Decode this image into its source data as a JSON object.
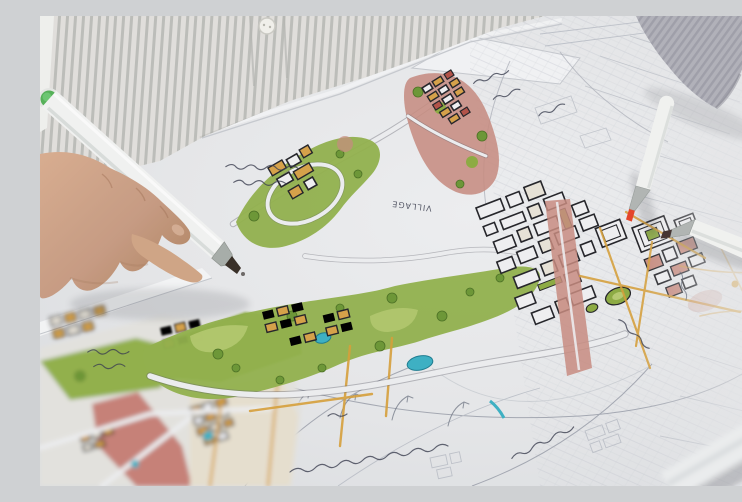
{
  "scene": {
    "type": "photograph",
    "description": "Close-up of an urban designer leaning over a hand-rendered town masterplan, drawing on it with a chisel-tip marker while other markers lie on the sheet",
    "subject": "hand-drawn urban planning map with marker rendering",
    "setting": "white table, person wearing a grey pinstripe shirt; second arm in a grey ribbed sleeve rests at top right"
  },
  "people": {
    "drawing_hand": "hand entering from the left, gripping a white marker whose tip touches the plan",
    "resting_arm": "forearm in grey ribbed sleeve with bare wrist, top-right corner"
  },
  "shirt": {
    "pattern": "grey pinstripe",
    "stripe_color": "#c4c5c1",
    "base_color": "#eceae6",
    "button_color": "#f4f3ee"
  },
  "markers": [
    {
      "id": "marker-in-hand",
      "body_color": "#f4f5f4",
      "cap_end_color": "#57b35a",
      "tip_color": "#3a3028",
      "state": "held in hand, tip on paper"
    },
    {
      "id": "marker-red-tip",
      "body_color": "#f4f5f3",
      "ferrule_color": "#b4b8b6",
      "tip_color": "#e8472b",
      "state": "uncapped, lying on plan"
    },
    {
      "id": "marker-brown-tip",
      "body_color": "#f4f5f3",
      "ferrule_color": "#b4b8b6",
      "tip_color": "#473634",
      "state": "uncapped, lying on plan, extends off right edge"
    },
    {
      "id": "marker-capped",
      "body_color": "#eef0f1",
      "ring_color": "#e58a45",
      "state": "capped, out of focus, bottom-right foreground"
    }
  ],
  "plan": {
    "media": "ink linework with marker rendering on white paper; unrendered pencil sketch at right and bottom",
    "legend_colors": {
      "vegetation_green": "#94b34e",
      "building_orange": "#d9a44b",
      "mixed_use_pink": "#cb8e82",
      "accent_red": "#b5544a",
      "water_teal": "#3fb3c6",
      "road_gold": "#d9a23c",
      "ink": "#26262b",
      "pencil": "#a7abb5",
      "paper": "#e9eaec"
    },
    "annotations": [
      {
        "id": "village-label",
        "text": "VILLAGE",
        "orientation": "upside-down handwriting"
      },
      {
        "id": "other-labels",
        "text": "(illegible handwritten notes, written upside-down toward the designer)"
      }
    ],
    "features": [
      "central green park band with two teal ponds and a creek",
      "residential clusters of small orange and white buildings",
      "town-centre grid of white blocks with heavy ink outlines",
      "pink mixed-use corridor and rose blocks",
      "green roundabout ovals",
      "gold street network",
      "large pencil arcs, curved arrows and note strings at bottom",
      "faint pencil street grid fading out at right"
    ]
  },
  "palette": {
    "table": "#f3f3f1",
    "paper": "#e9eaec",
    "sleeve": "#b2b2ba",
    "skin": "#c99e85"
  }
}
